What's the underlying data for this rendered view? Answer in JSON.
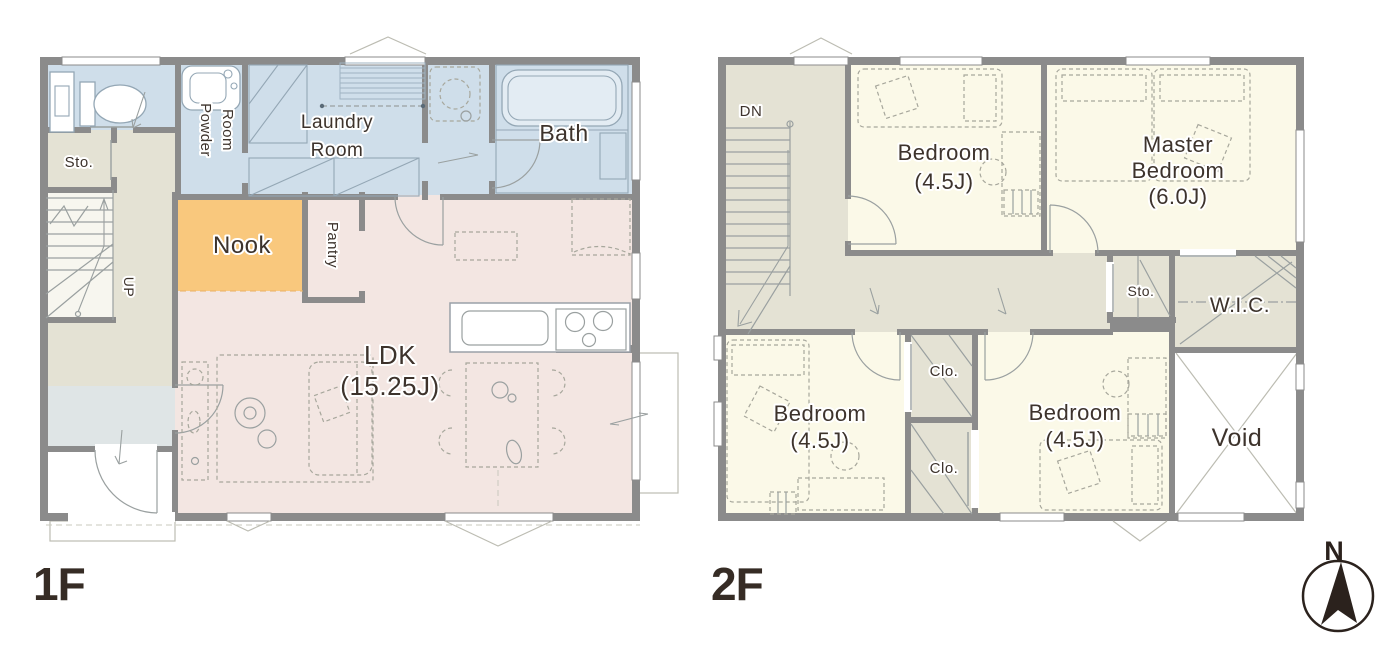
{
  "colors": {
    "wall": "#8b8b8b",
    "water_room": "#cfdeea",
    "beige": "#e4e2d4",
    "genkan": "#dfe5e6",
    "nook": "#f9c87d",
    "ldk": "#f3e6e2",
    "bedroom": "#fbf9e8",
    "line": "#9aa0a0",
    "furniture_line": "#a7a79c",
    "text": "#3d332c",
    "compass": "#2b221d"
  },
  "floor1": {
    "name": "1F",
    "rooms": {
      "sto": "Sto.",
      "powder1": "Powder",
      "powder2": "Room",
      "laundry1": "Laundry",
      "laundry2": "Room",
      "bath": "Bath",
      "nook": "Nook",
      "pantry": "Pantry",
      "ldk1": "LDK",
      "ldk2": "(15.25J)",
      "up": "UP"
    }
  },
  "floor2": {
    "name": "2F",
    "rooms": {
      "dn": "DN",
      "bedroom_top1": "Bedroom",
      "bedroom_top2": "(4.5J)",
      "master1": "Master",
      "master2": "Bedroom",
      "master3": "(6.0J)",
      "sto": "Sto.",
      "wic": "W.I.C.",
      "clo_upper": "Clo.",
      "clo_lower": "Clo.",
      "bedroom_bl1": "Bedroom",
      "bedroom_bl2": "(4.5J)",
      "bedroom_br1": "Bedroom",
      "bedroom_br2": "(4.5J)",
      "void": "Void"
    }
  },
  "compass": {
    "north": "N"
  }
}
